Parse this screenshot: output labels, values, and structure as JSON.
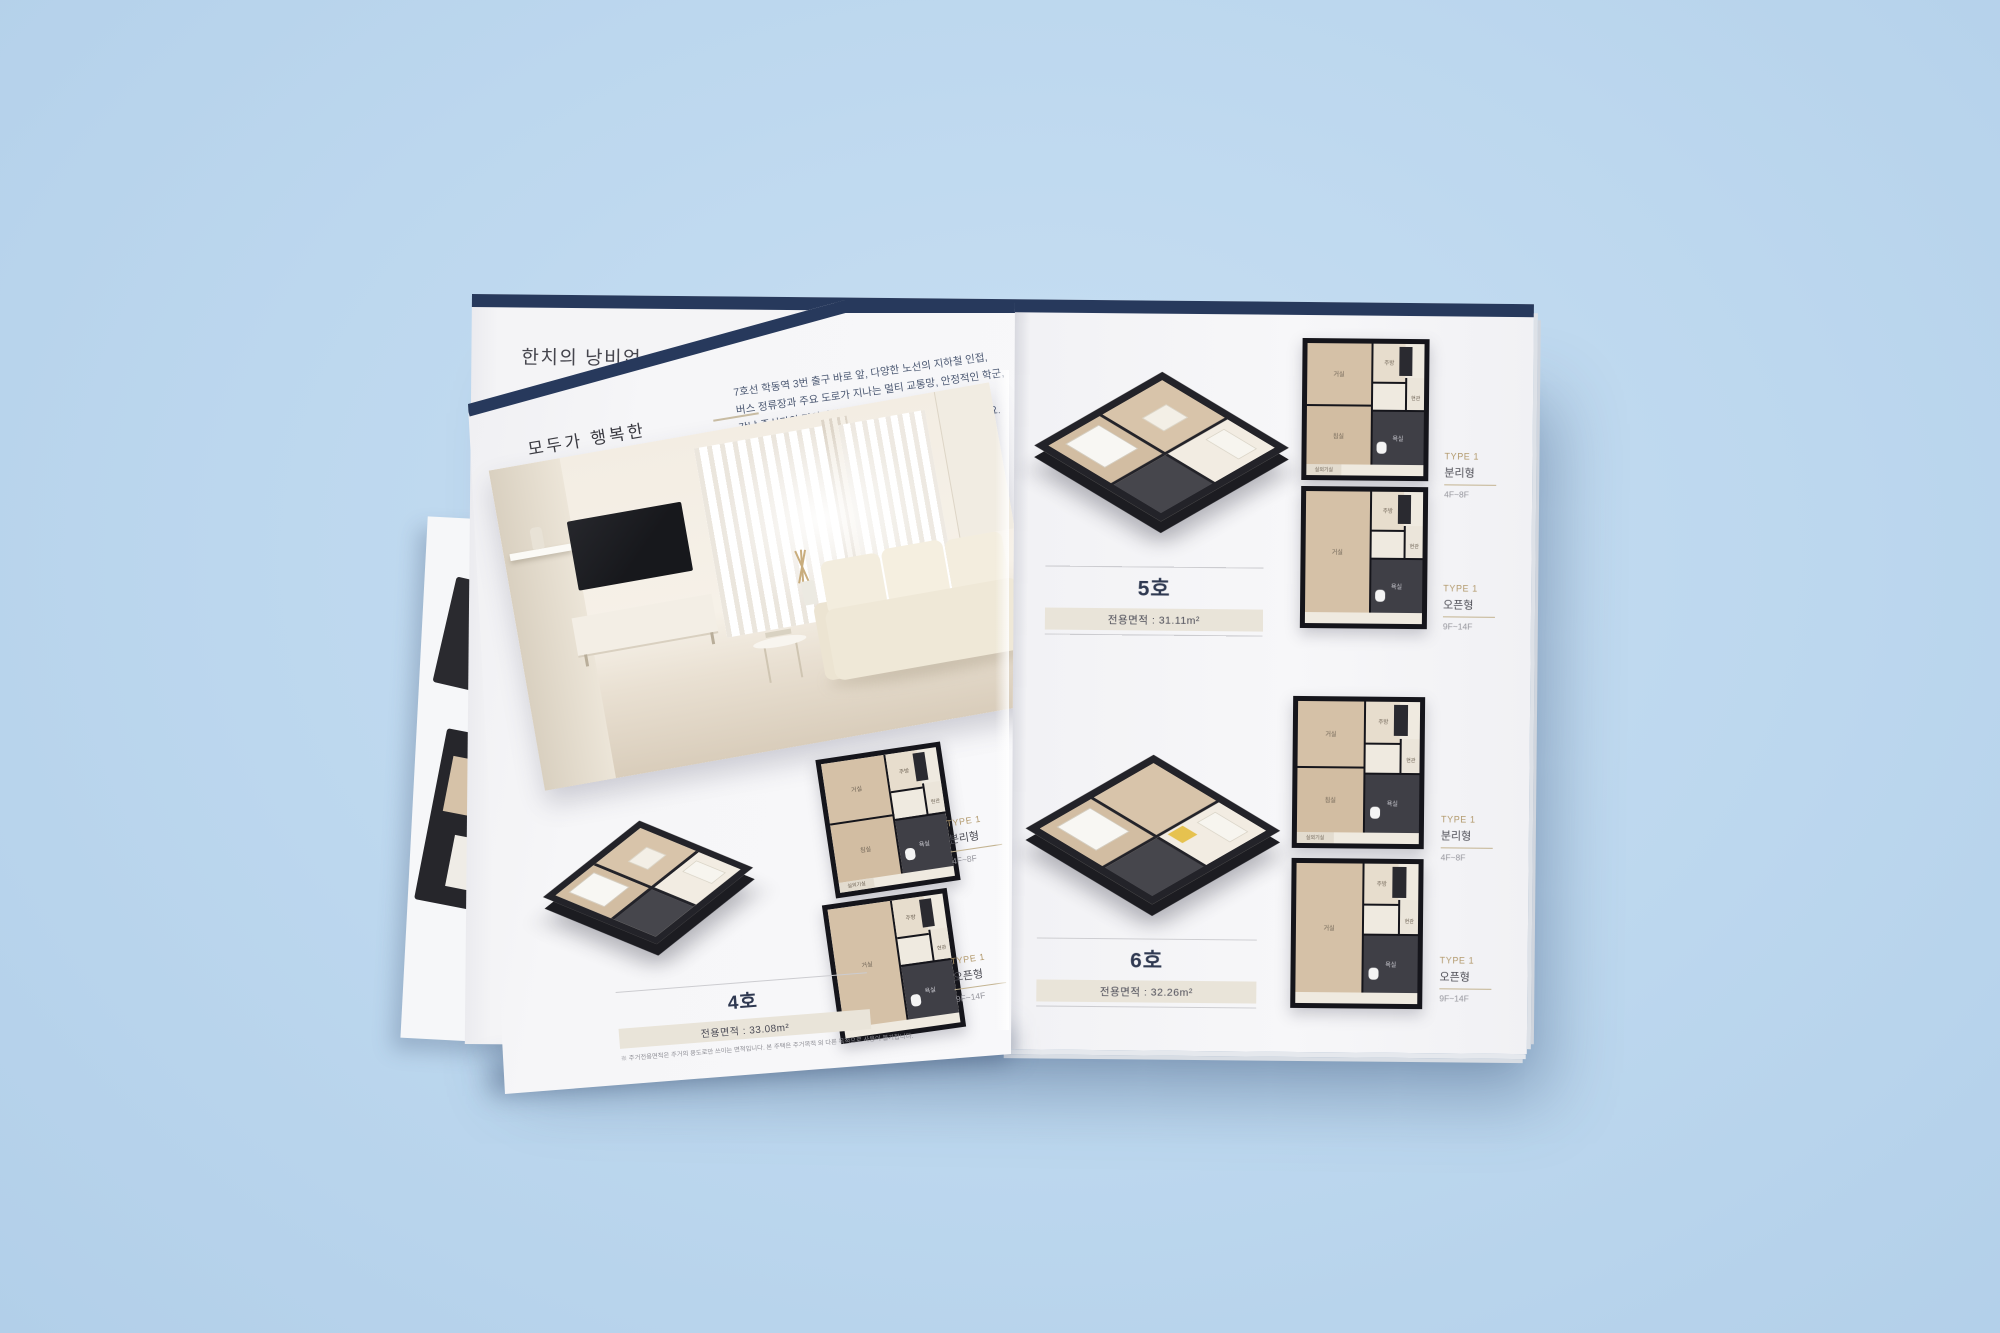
{
  "colors": {
    "background": "#bcd7ee",
    "navy_bar": "#27395c",
    "page": "#f4f4f6",
    "area_bar_bg": "#e9e4d9",
    "type_gold": "#b2996c",
    "title_navy": "#2c3a60"
  },
  "under_page": {
    "title_partial": "한치의 낭비없",
    "footnote_partial": "※ 주거전용면적은 주거의 용도"
  },
  "overlay_page": {
    "eyebrow": "모두가 행복한",
    "title": "생활 인프라",
    "paragraph_lines": [
      "7호선 학동역 3번 출구 바로 앞, 다양한 노선의 지하철 인접,",
      "버스 정류장과 주요 도로가 지나는 멀티 교통망, 안정적인 학군,",
      "강남 중심가의 편의시설 등 누구에게나 편리한 인프라!",
      "학동역 이안 테라디움의 독보적 위치에서 생활을 누려보세요."
    ],
    "unit": {
      "name": "4호",
      "area": "전용면적 : 33.08m²"
    },
    "types": [
      {
        "tag": "TYPE 1",
        "plan": "분리형",
        "floors": "4F~8F"
      },
      {
        "tag": "TYPE 1",
        "plan": "오픈형",
        "floors": "9F~14F"
      }
    ],
    "footnote": "※ 주거전용면적은 주거의 용도로만 쓰이는 면적입니다. 본 주택은 주거목적 외 다른 목적으로 사용이 불가합니다."
  },
  "right_page": {
    "units": [
      {
        "name": "5호",
        "area": "전용면적 : 31.11m²",
        "types": [
          {
            "tag": "TYPE 1",
            "plan": "분리형",
            "floors": "4F~8F"
          },
          {
            "tag": "TYPE 1",
            "plan": "오픈형",
            "floors": "9F~14F"
          }
        ]
      },
      {
        "name": "6호",
        "area": "전용면적 : 32.26m²",
        "types": [
          {
            "tag": "TYPE 1",
            "plan": "분리형",
            "floors": "4F~8F"
          },
          {
            "tag": "TYPE 1",
            "plan": "오픈형",
            "floors": "9F~14F"
          }
        ]
      }
    ]
  },
  "rooms": {
    "living": "거실",
    "bedroom": "침실",
    "kitchen": "주방",
    "bath": "욕실",
    "entry": "현관",
    "util": "실외기실"
  }
}
